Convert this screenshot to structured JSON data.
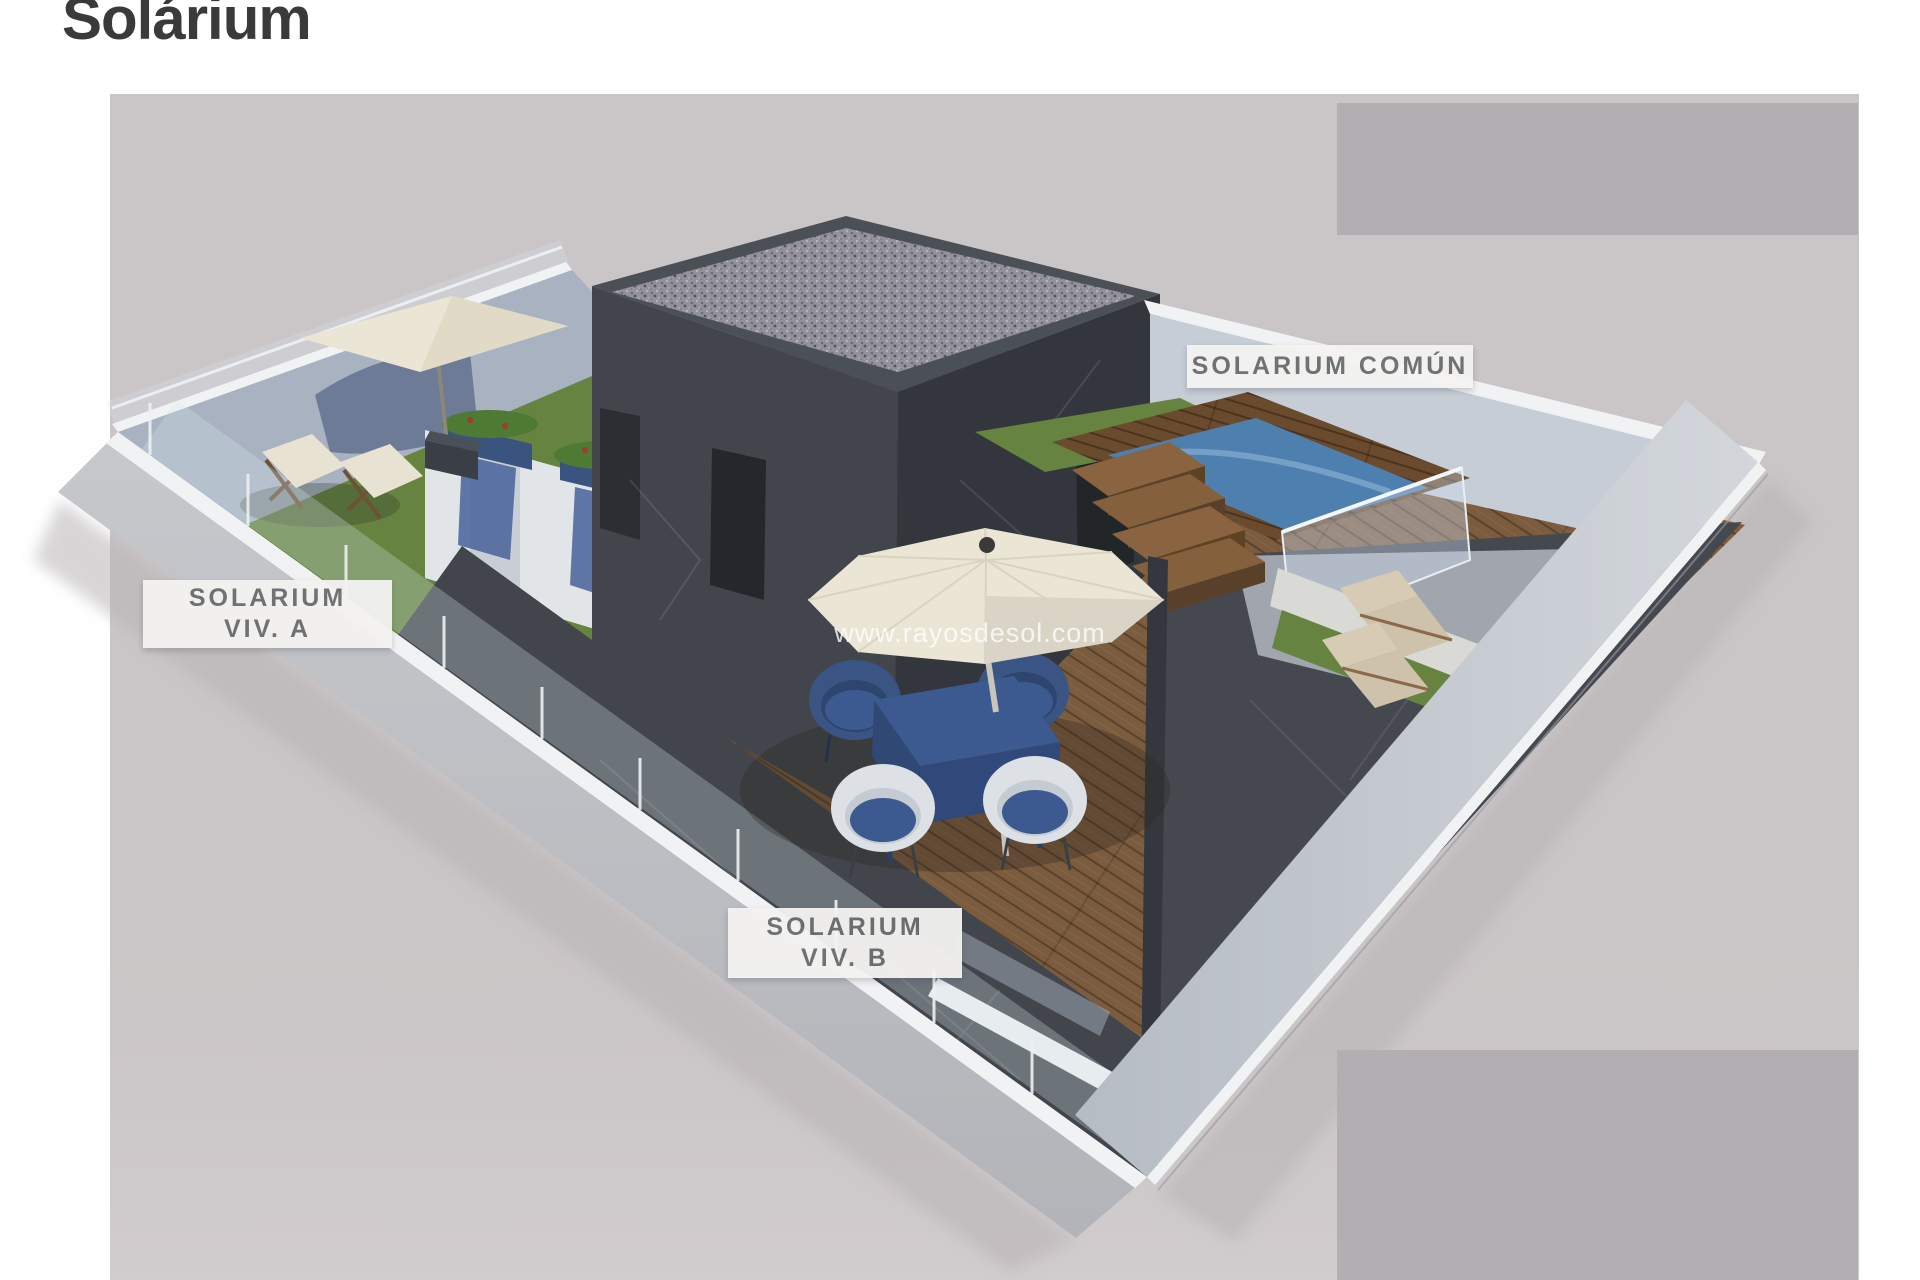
{
  "page": {
    "title": "Solárium"
  },
  "watermark": "www.rayosdesol.com",
  "labels": {
    "common": "SOLARIUM COMÚN",
    "viv_a": {
      "line1": "SOLARIUM",
      "line2": "VIV. A"
    },
    "viv_b": {
      "line1": "SOLARIUM",
      "line2": "VIV. B"
    }
  },
  "colors": {
    "title": "#3a3a3c",
    "photo_bg": "#cac5c6",
    "redaction": "#b3aeb2",
    "label_bg": "#f4f3f1",
    "label_text": "#6b6d6e",
    "watermark": "#ffffff",
    "wall_dark": "#42464c",
    "wall_dark_deep": "#33373d",
    "wall_light": "#a8b2c1",
    "wall_lighter": "#c6cdd6",
    "edge_white": "#f1f2f3",
    "wood": "#7c5c3e",
    "wood_dark": "#6b4b2d",
    "grass": "#66833f",
    "pool": "#4e80af",
    "umbrella": "#eae5d5",
    "furniture_blue": "#3d5a90",
    "wicker_white": "#dde1e6",
    "stone_white": "#d9dad5"
  }
}
